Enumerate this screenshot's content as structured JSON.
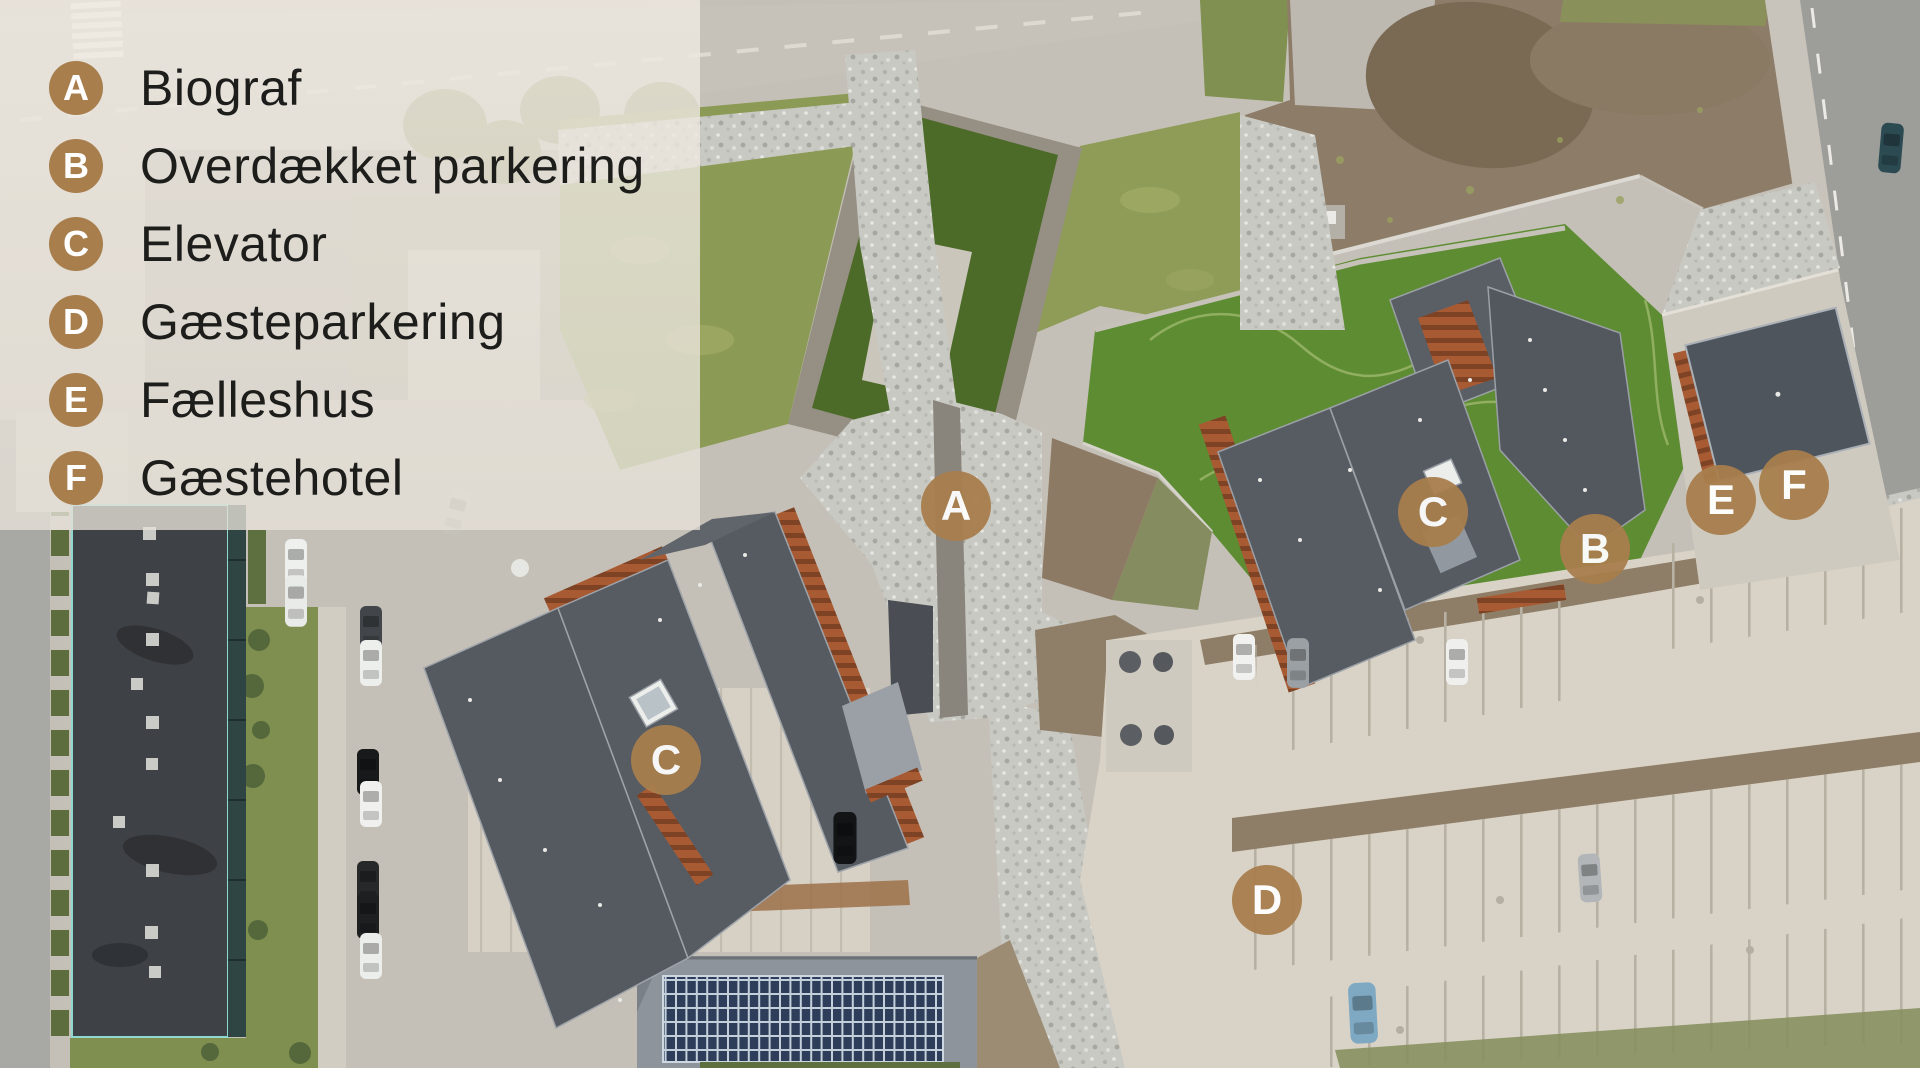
{
  "legend": {
    "items": [
      {
        "letter": "A",
        "label": "Biograf"
      },
      {
        "letter": "B",
        "label": "Overdækket parkering"
      },
      {
        "letter": "C",
        "label": "Elevator"
      },
      {
        "letter": "D",
        "label": "Gæsteparkering"
      },
      {
        "letter": "E",
        "label": "Fælleshus"
      },
      {
        "letter": "F",
        "label": "Gæstehotel"
      }
    ],
    "marker_color": "#a87e4d",
    "text_color": "#1d1d1b"
  },
  "map_markers": [
    {
      "letter": "A",
      "x": 956,
      "y": 506
    },
    {
      "letter": "C",
      "x": 666,
      "y": 760
    },
    {
      "letter": "C",
      "x": 1433,
      "y": 512
    },
    {
      "letter": "B",
      "x": 1595,
      "y": 549
    },
    {
      "letter": "E",
      "x": 1721,
      "y": 500
    },
    {
      "letter": "F",
      "x": 1794,
      "y": 485
    },
    {
      "letter": "D",
      "x": 1267,
      "y": 900
    }
  ]
}
